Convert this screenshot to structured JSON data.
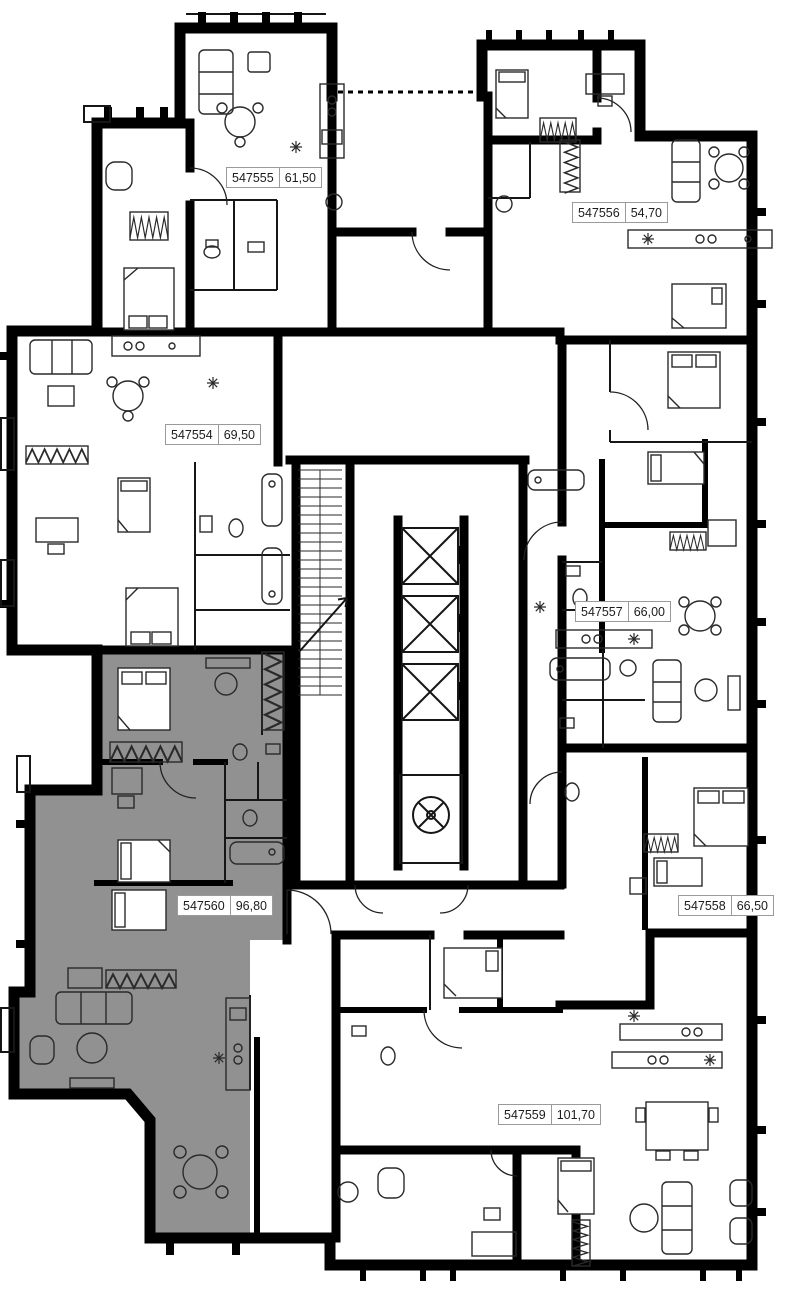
{
  "floor_plan": {
    "colors": {
      "background": "#ffffff",
      "wall": "#000000",
      "highlight": "#919191",
      "label_border": "#9a9a9a"
    },
    "units": [
      {
        "id": "547555",
        "area": "61,50",
        "selected": false
      },
      {
        "id": "547556",
        "area": "54,70",
        "selected": false
      },
      {
        "id": "547554",
        "area": "69,50",
        "selected": false
      },
      {
        "id": "547557",
        "area": "66,00",
        "selected": false
      },
      {
        "id": "547560",
        "area": "96,80",
        "selected": true
      },
      {
        "id": "547558",
        "area": "66,50",
        "selected": false
      },
      {
        "id": "547559",
        "area": "101,70",
        "selected": false
      }
    ]
  }
}
